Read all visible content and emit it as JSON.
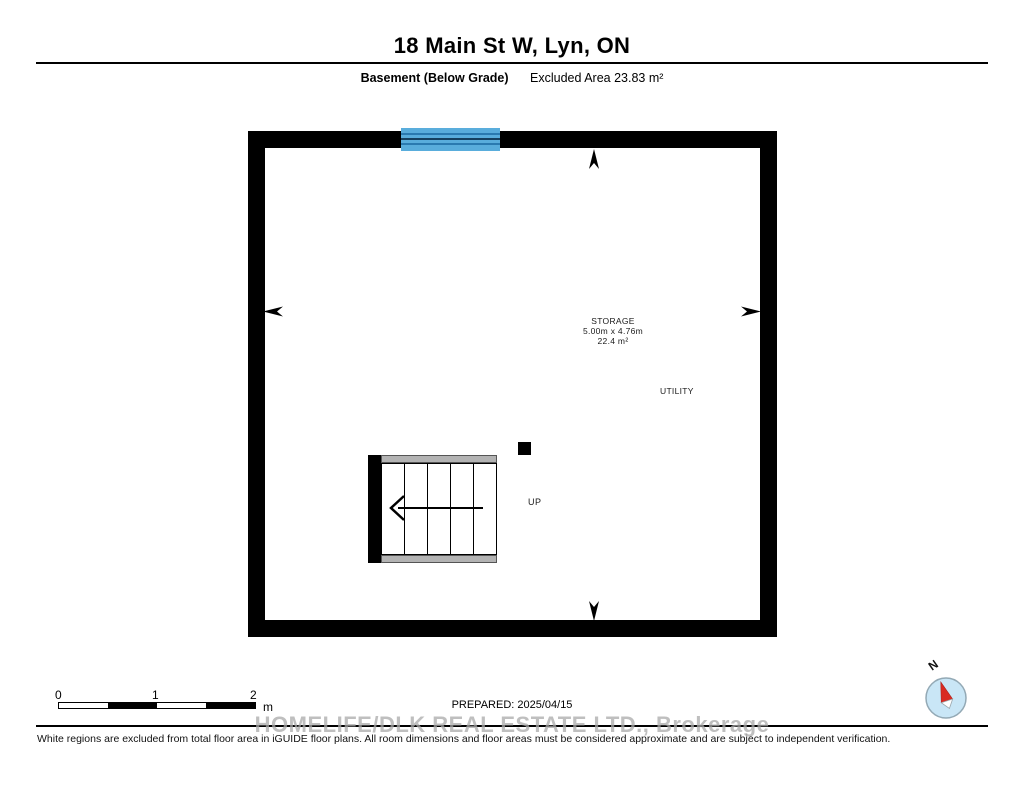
{
  "header": {
    "title": "18 Main St W, Lyn, ON",
    "floor_label": "Basement (Below Grade)",
    "excluded_area": "Excluded Area 23.83 m²"
  },
  "plan": {
    "rooms": [
      {
        "name": "STORAGE",
        "dimensions": "5.00m x 4.76m",
        "area": "22.4 m²"
      },
      {
        "name": "UTILITY"
      }
    ],
    "stairs": {
      "label": "UP"
    }
  },
  "scale_bar": {
    "ticks": [
      "0",
      "1",
      "2"
    ],
    "unit": "m"
  },
  "footer": {
    "prepared": "PREPARED: 2025/04/15",
    "watermark": "HOMELIFE/DLK REAL ESTATE LTD., Brokerage",
    "disclaimer": "White regions are excluded from total floor area in iGUIDE floor plans. All room dimensions and floor areas must be considered approximate and are subject to independent verification."
  },
  "compass": {
    "north_label": "N"
  },
  "colors": {
    "wall": "#000000",
    "window_fill": "#59ADDC",
    "window_stripe": "#2A7AB0",
    "window_stripe_center": "#15405F",
    "stair_strip": "#B3B3B3",
    "watermark": "#AAAAAA",
    "compass_fill": "#C9E6F6",
    "compass_needle": "#D92B23"
  }
}
